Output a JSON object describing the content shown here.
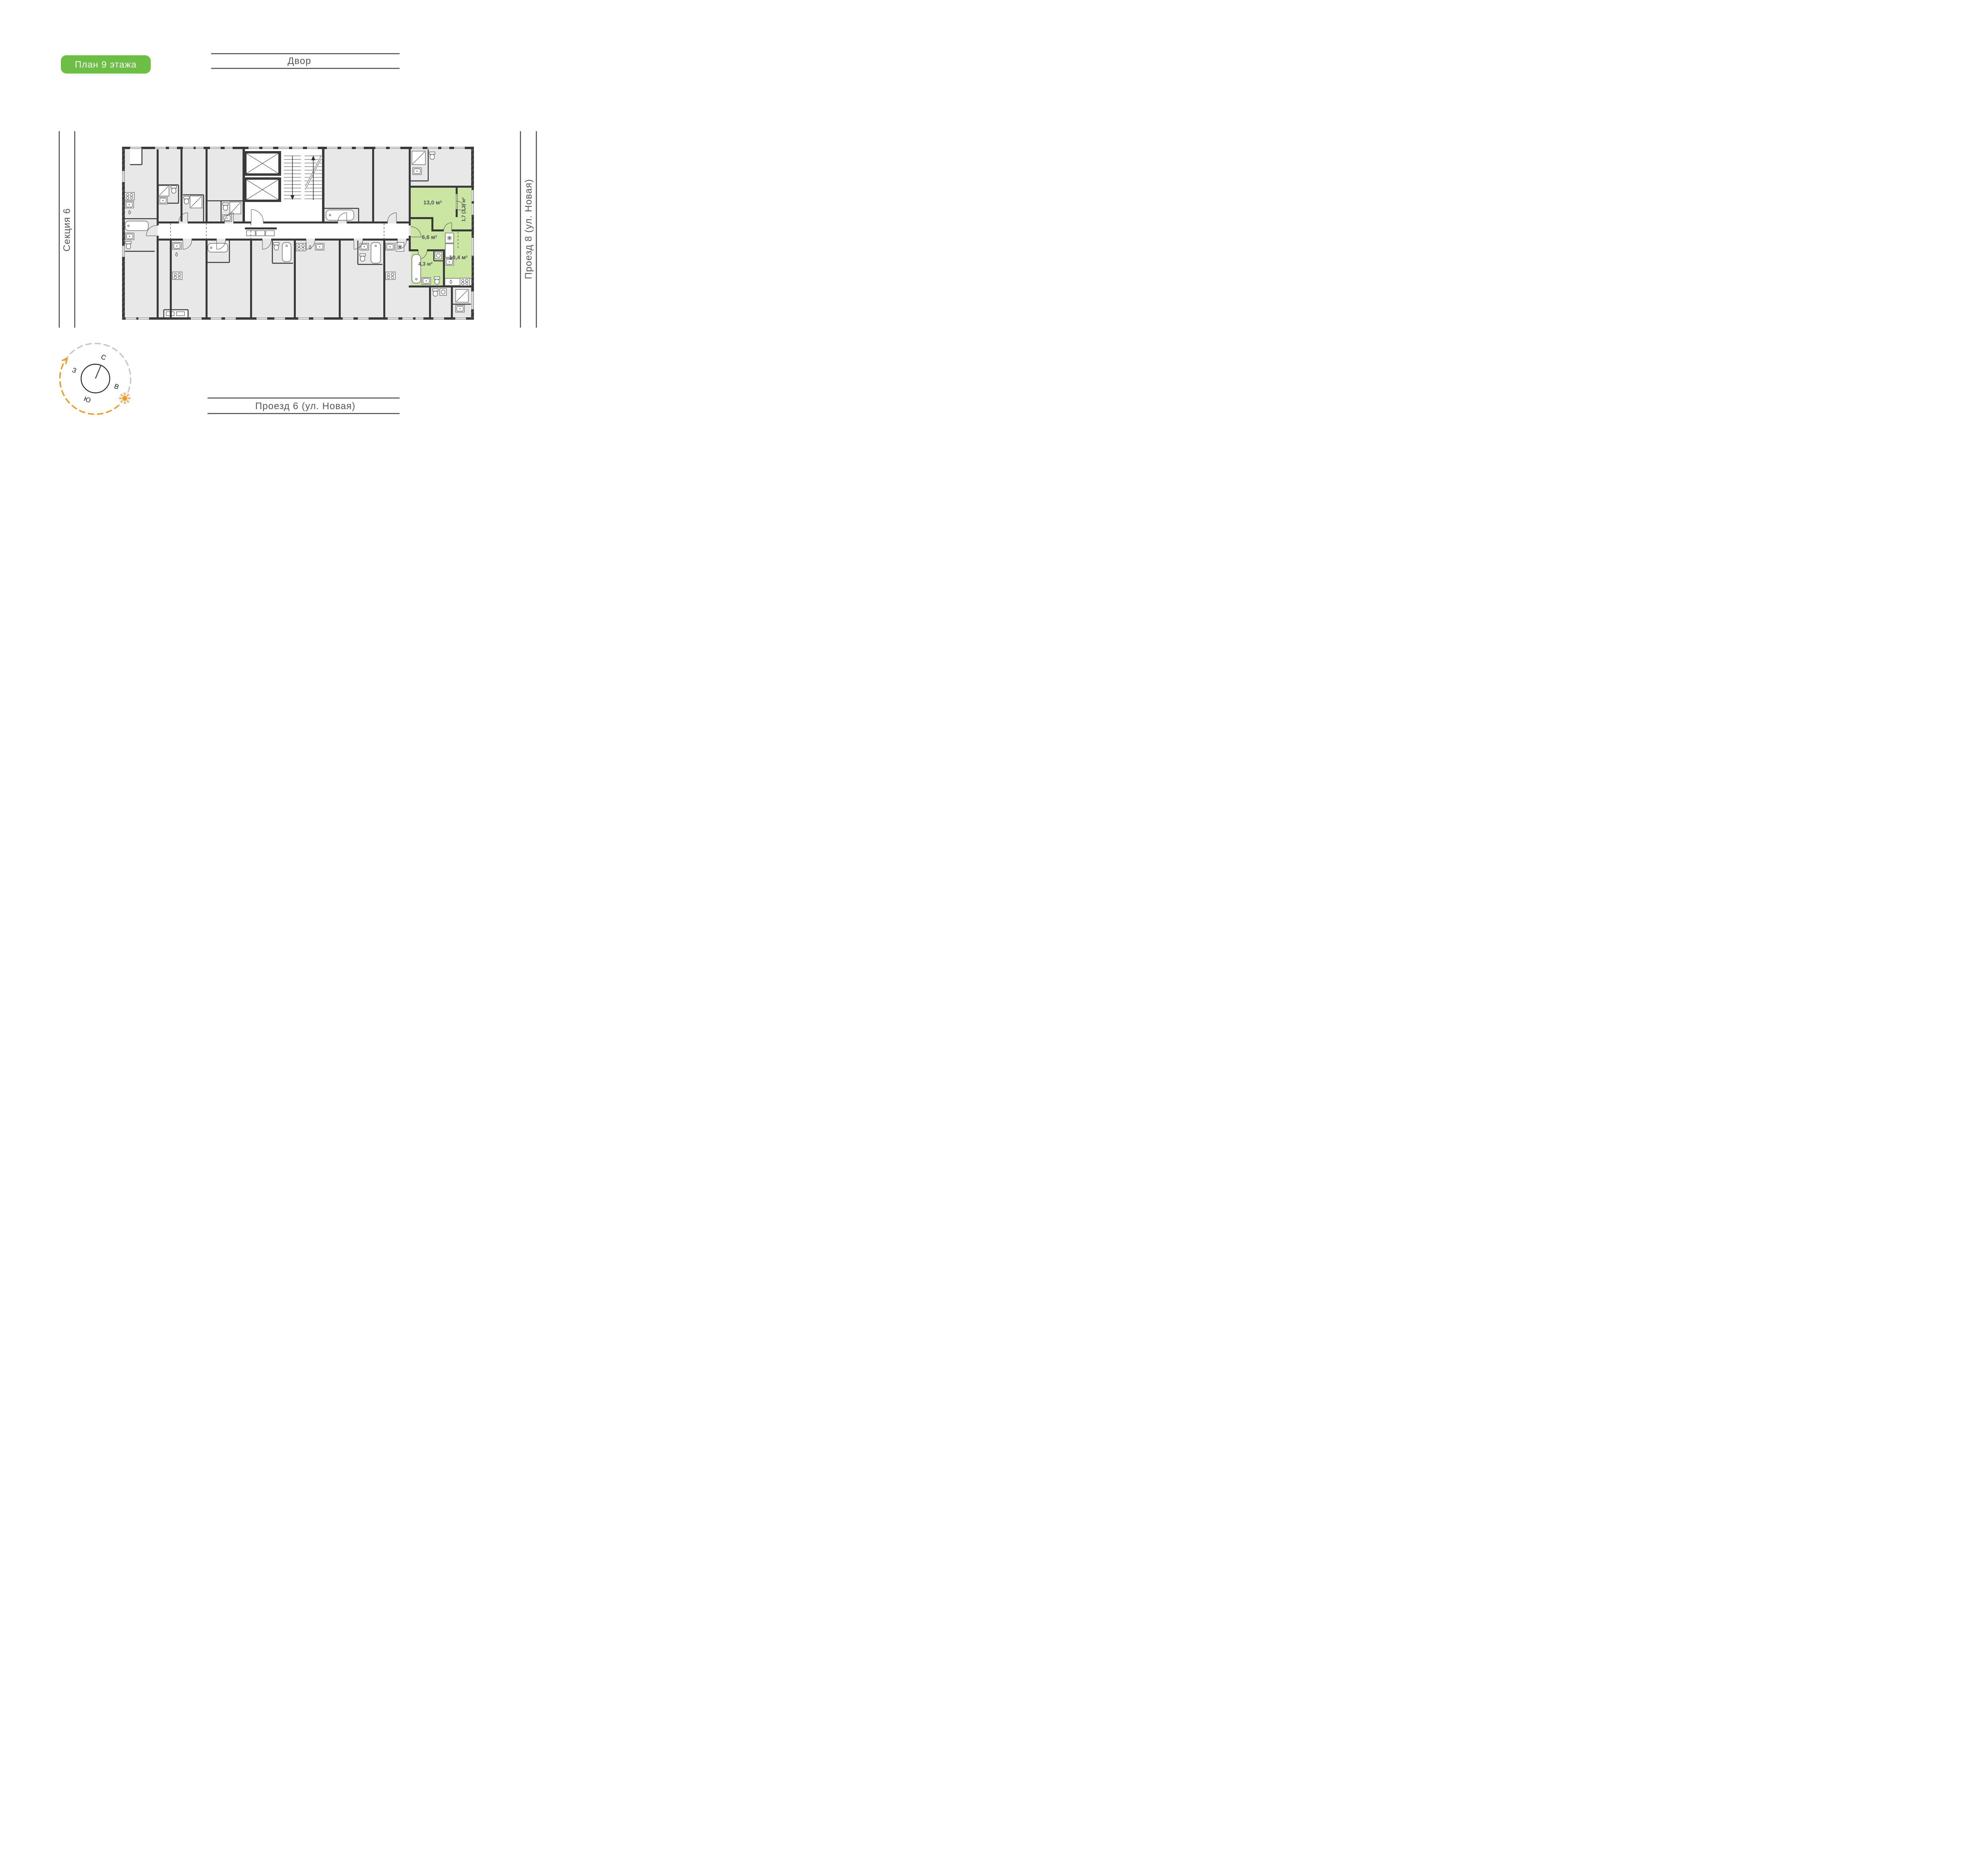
{
  "badge": {
    "label": "План 9 этажа",
    "bg_color": "#6CBE45",
    "text_color": "#FFFFFF"
  },
  "surroundings": {
    "top": "Двор",
    "left": "Секция 6",
    "right": "Проезд 8 (ул. Новая)",
    "bottom": "Проезд 6 (ул. Новая)"
  },
  "apartment": {
    "highlight_color": "#CBE5A2",
    "rooms": {
      "living": {
        "label": "13,0 м²"
      },
      "balcony": {
        "label": "1,7 (3,3) м²"
      },
      "hallway": {
        "label": "6,6 м²"
      },
      "kitchen": {
        "label": "10,4 м²"
      },
      "bathroom": {
        "label": "4,3 м²"
      }
    }
  },
  "compass": {
    "north": "С",
    "east": "В",
    "south": "Ю",
    "west": "З"
  },
  "colors": {
    "badge_green": "#6CBE45",
    "apartment_highlight": "#CBE5A2",
    "wall_dark": "#3A3A3C",
    "room_gray": "#E8E8E9",
    "accent_orange": "#F39A1E",
    "dash_gray": "#C8C8C8"
  }
}
